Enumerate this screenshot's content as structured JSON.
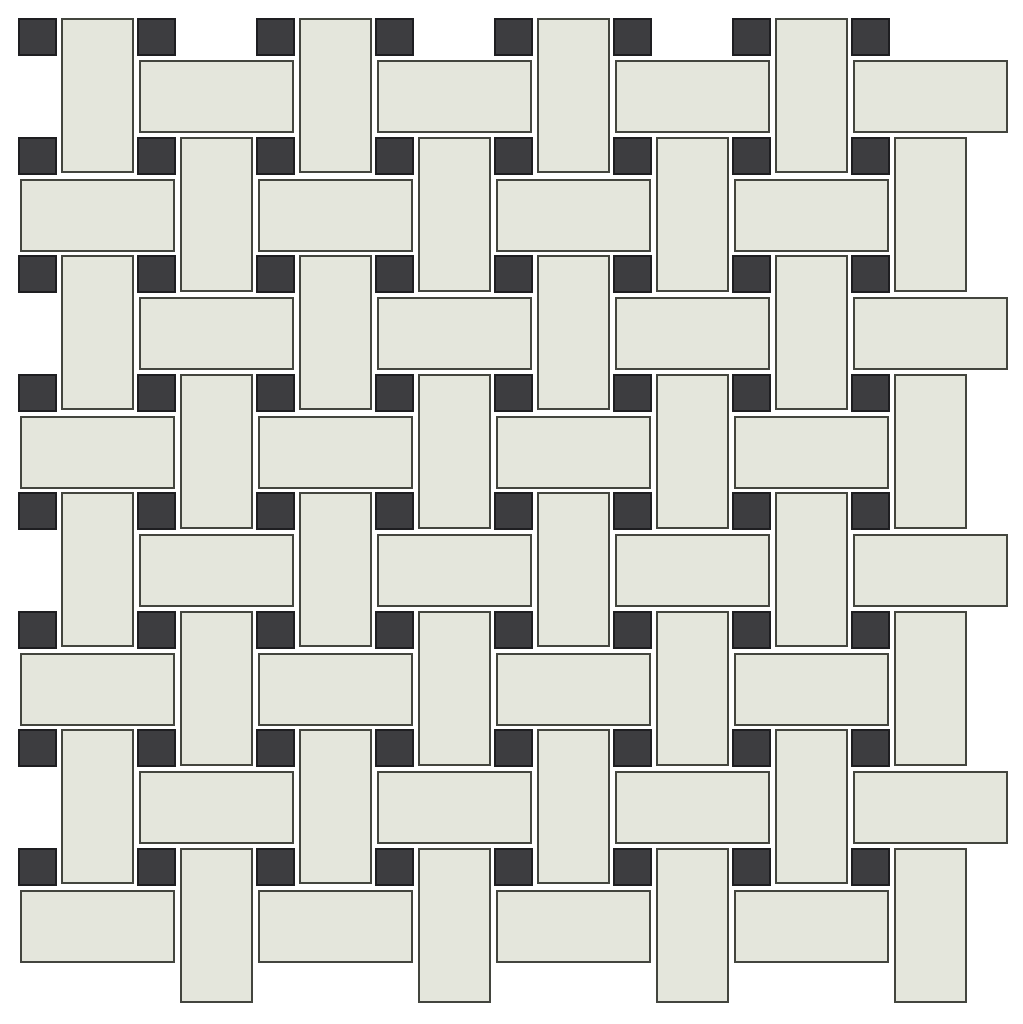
{
  "canvas": {
    "width": 1023,
    "height": 1024,
    "background_color": "#ffffff"
  },
  "pattern": {
    "name": "basketweave-mosaic-with-dots",
    "description": "Basketweave mosaic sheet: alternating horizontal and vertical rectangular tiles woven around small square dot inserts",
    "grid": {
      "origin_x": 18,
      "origin_y": 18,
      "pitch_x": 119,
      "pitch_y": 118.5,
      "dot_cols": 8,
      "dot_rows": 8
    },
    "dot_tile": {
      "width": 39,
      "height": 38,
      "fill": "#3d3d40",
      "border_color": "#1e1e21",
      "border_width": 2,
      "count": 64
    },
    "rect_tile": {
      "long_side": 155,
      "short_side": 73,
      "vertical_offset_x": 42.5,
      "horizontal_offset_y": 42,
      "horizontal_offset_x": 1.5,
      "fill": "#e4e6dc",
      "border_color": "#43453e",
      "border_width": 2,
      "vertical_count": 32,
      "horizontal_count": 32
    },
    "grout_color": "#ffffff"
  }
}
